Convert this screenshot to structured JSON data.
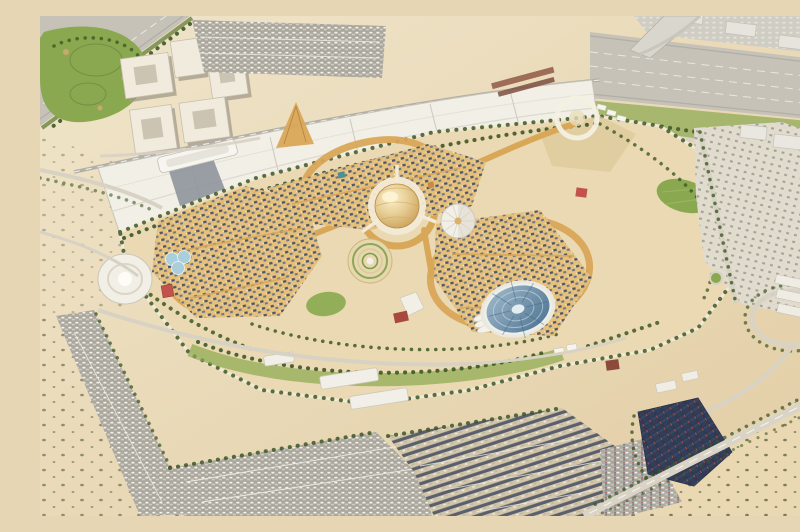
{
  "image": {
    "title": "Daytime aerial 3D rendering of a desert expo master plan: a central golden dome plaza with three dense pavilion districts linked by gold tree-lined boulevards, long white exhibition halls and a metro line to the north-west, high-rise towers and a golf course in the top-left corner, a multi-lane highway across the top-right, vast surface car parks to the south, a steel-blue domed arena, a white radial fan canopy, a circular spiral garden, a dark solar-panel roof cluster at the south-east, and open scrub desert beyond"
  },
  "colors": {
    "sand_light": "#f0e5ca",
    "sand_dark": "#e2cda4",
    "desert": "#e9d8b2",
    "expo_sand": "#ead9b2",
    "highway": "#c6c2b8",
    "road": "#d8d2c4",
    "rail": "#b2afa6",
    "parking": "#aaa69c",
    "lawn": "#8aa84f",
    "green": "#6b8440",
    "tree": "#3d5727",
    "gold": "#d9a758",
    "gold_light": "#e5c07a",
    "roof": "#4e5568",
    "white": "#f2efe6",
    "dome_gold": "#d9b26d",
    "arena_blue": "#49708f",
    "village": "#e2dccd",
    "solar_navy": "#2f3950",
    "accent_red": "#c2524a"
  },
  "landmarks": [
    {
      "id": "central-dome",
      "label": "central golden dome"
    },
    {
      "id": "al-wasl-plaza",
      "label": "circular plaza ring around the dome"
    },
    {
      "id": "fan-canopy-pavilion",
      "label": "white radial fan canopy pavilion"
    },
    {
      "id": "spiral-garden",
      "label": "circular terraced spiral garden"
    },
    {
      "id": "trefoil-pavilion",
      "label": "white oval trefoil pavilion"
    },
    {
      "id": "blue-dome-arena",
      "label": "steel-blue ribbed dome arena"
    },
    {
      "id": "gold-boulevards",
      "label": "three looping gold boulevards"
    },
    {
      "id": "district-west",
      "label": "western pavilion district"
    },
    {
      "id": "district-north",
      "label": "northern pavilion district"
    },
    {
      "id": "district-east",
      "label": "eastern pavilion district"
    },
    {
      "id": "exhibition-halls",
      "label": "long white exhibition halls"
    },
    {
      "id": "metro-station",
      "label": "white metro station canopy"
    },
    {
      "id": "residential-towers",
      "label": "beige high-rise tower cluster"
    },
    {
      "id": "golf-course",
      "label": "golf course greens"
    },
    {
      "id": "highway-northeast",
      "label": "multi-lane highway corridor"
    },
    {
      "id": "highway-northwest",
      "label": "north-west highway corridor"
    },
    {
      "id": "car-parks",
      "label": "large surface car parks"
    },
    {
      "id": "solar-roof-cluster",
      "label": "dark solar-panel roofed cluster with red fins"
    },
    {
      "id": "village-east",
      "label": "dense low-rise district outside the gate"
    },
    {
      "id": "interchange-loop",
      "label": "oval interchange loop with white compound"
    },
    {
      "id": "ring-plaza",
      "label": "white circular gate plaza"
    },
    {
      "id": "falcon-pavilion",
      "label": "white winged-roof pavilion"
    },
    {
      "id": "desert-scrub",
      "label": "open desert with scattered shrubs"
    }
  ]
}
